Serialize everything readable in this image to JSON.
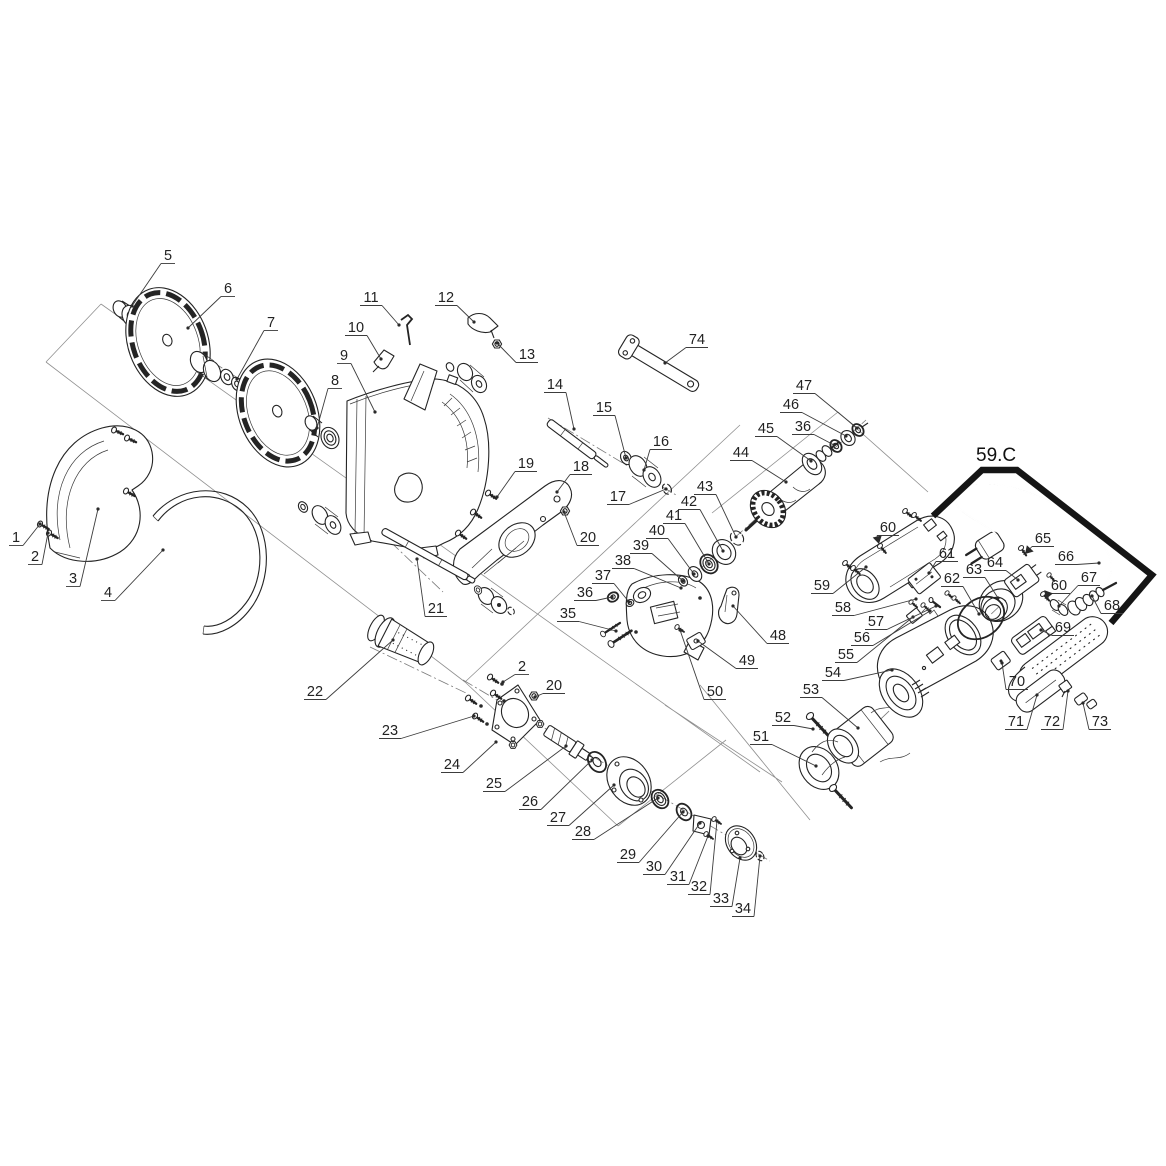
{
  "callout": {
    "label": "59.C",
    "label_x": 976,
    "label_y": 461,
    "bracket_points": "933,516 982,470 1017,470 1152,575 1111,623"
  },
  "colors": {
    "line_art": "#242424",
    "bracket": "#151515",
    "background": "#ffffff"
  },
  "labels": [
    {
      "n": "1",
      "x": 16,
      "y": 537,
      "px": 40,
      "py": 524
    },
    {
      "n": "2",
      "x": 35,
      "y": 556,
      "px": 48,
      "py": 533
    },
    {
      "n": "3",
      "x": 73,
      "y": 578,
      "px": 98,
      "py": 509
    },
    {
      "n": "4",
      "x": 108,
      "y": 592,
      "px": 163,
      "py": 550
    },
    {
      "n": "5",
      "x": 168,
      "y": 255,
      "px": 132,
      "py": 306
    },
    {
      "n": "6",
      "x": 228,
      "y": 288,
      "px": 188,
      "py": 328
    },
    {
      "n": "7",
      "x": 271,
      "y": 322,
      "px": 237,
      "py": 379
    },
    {
      "n": "8",
      "x": 335,
      "y": 380,
      "px": 317,
      "py": 428
    },
    {
      "n": "9",
      "x": 344,
      "y": 355,
      "px": 375,
      "py": 412
    },
    {
      "n": "10",
      "x": 356,
      "y": 327,
      "px": 381,
      "py": 359
    },
    {
      "n": "11",
      "x": 371,
      "y": 297,
      "px": 399,
      "py": 325
    },
    {
      "n": "12",
      "x": 446,
      "y": 297,
      "px": 474,
      "py": 322
    },
    {
      "n": "13",
      "x": 527,
      "y": 354,
      "px": 497,
      "py": 343
    },
    {
      "n": "14",
      "x": 555,
      "y": 384,
      "px": 574,
      "py": 429
    },
    {
      "n": "15",
      "x": 604,
      "y": 407,
      "px": 626,
      "py": 458
    },
    {
      "n": "16",
      "x": 661,
      "y": 441,
      "px": 644,
      "py": 470
    },
    {
      "n": "17",
      "x": 618,
      "y": 496,
      "px": 666,
      "py": 489
    },
    {
      "n": "18",
      "x": 581,
      "y": 466,
      "px": 557,
      "py": 492
    },
    {
      "n": "19",
      "x": 526,
      "y": 463,
      "px": 497,
      "py": 497
    },
    {
      "n": "20",
      "x": 588,
      "y": 537,
      "px": 564,
      "py": 512
    },
    {
      "n": "20",
      "x": 554,
      "y": 685,
      "px": 535,
      "py": 697
    },
    {
      "n": "2",
      "x": 522,
      "y": 666,
      "px": 503,
      "py": 682
    },
    {
      "n": "21",
      "x": 436,
      "y": 608,
      "px": 417,
      "py": 559
    },
    {
      "n": "22",
      "x": 315,
      "y": 691,
      "px": 393,
      "py": 640
    },
    {
      "n": "23",
      "x": 390,
      "y": 730,
      "px": 474,
      "py": 716
    },
    {
      "n": "24",
      "x": 452,
      "y": 764,
      "px": 496,
      "py": 742
    },
    {
      "n": "25",
      "x": 494,
      "y": 783,
      "px": 566,
      "py": 746
    },
    {
      "n": "26",
      "x": 530,
      "y": 801,
      "px": 592,
      "py": 760
    },
    {
      "n": "27",
      "x": 558,
      "y": 817,
      "px": 614,
      "py": 785
    },
    {
      "n": "28",
      "x": 583,
      "y": 831,
      "px": 658,
      "py": 798
    },
    {
      "n": "29",
      "x": 628,
      "y": 854,
      "px": 683,
      "py": 812
    },
    {
      "n": "30",
      "x": 654,
      "y": 866,
      "px": 700,
      "py": 823
    },
    {
      "n": "31",
      "x": 678,
      "y": 876,
      "px": 708,
      "py": 836
    },
    {
      "n": "32",
      "x": 699,
      "y": 886,
      "px": 717,
      "py": 821
    },
    {
      "n": "33",
      "x": 721,
      "y": 898,
      "px": 740,
      "py": 858
    },
    {
      "n": "34",
      "x": 743,
      "y": 908,
      "px": 760,
      "py": 856
    },
    {
      "n": "35",
      "x": 568,
      "y": 613,
      "px": 616,
      "py": 631
    },
    {
      "n": "36",
      "x": 585,
      "y": 592,
      "px": 612,
      "py": 597
    },
    {
      "n": "37",
      "x": 603,
      "y": 575,
      "px": 629,
      "py": 602
    },
    {
      "n": "38",
      "x": 623,
      "y": 560,
      "px": 681,
      "py": 588
    },
    {
      "n": "39",
      "x": 641,
      "y": 545,
      "px": 683,
      "py": 581
    },
    {
      "n": "40",
      "x": 657,
      "y": 530,
      "px": 694,
      "py": 574
    },
    {
      "n": "41",
      "x": 674,
      "y": 515,
      "px": 709,
      "py": 564
    },
    {
      "n": "42",
      "x": 689,
      "y": 501,
      "px": 723,
      "py": 551
    },
    {
      "n": "43",
      "x": 705,
      "y": 486,
      "px": 736,
      "py": 537
    },
    {
      "n": "44",
      "x": 741,
      "y": 452,
      "px": 786,
      "py": 482
    },
    {
      "n": "45",
      "x": 766,
      "y": 428,
      "px": 811,
      "py": 461
    },
    {
      "n": "46",
      "x": 791,
      "y": 404,
      "px": 846,
      "py": 436
    },
    {
      "n": "47",
      "x": 804,
      "y": 385,
      "px": 857,
      "py": 428
    },
    {
      "n": "36",
      "x": 803,
      "y": 426,
      "px": 834,
      "py": 445
    },
    {
      "n": "48",
      "x": 778,
      "y": 635,
      "px": 733,
      "py": 606
    },
    {
      "n": "49",
      "x": 747,
      "y": 660,
      "px": 698,
      "py": 641
    },
    {
      "n": "50",
      "x": 715,
      "y": 691,
      "px": 680,
      "py": 630
    },
    {
      "n": "51",
      "x": 761,
      "y": 736,
      "px": 816,
      "py": 766
    },
    {
      "n": "52",
      "x": 783,
      "y": 717,
      "px": 813,
      "py": 729
    },
    {
      "n": "53",
      "x": 811,
      "y": 689,
      "px": 858,
      "py": 728
    },
    {
      "n": "54",
      "x": 833,
      "y": 672,
      "px": 892,
      "py": 670
    },
    {
      "n": "55",
      "x": 846,
      "y": 654,
      "px": 913,
      "py": 617
    },
    {
      "n": "56",
      "x": 862,
      "y": 637,
      "px": 930,
      "py": 611
    },
    {
      "n": "57",
      "x": 876,
      "y": 621,
      "px": 936,
      "py": 606
    },
    {
      "n": "58",
      "x": 843,
      "y": 607,
      "px": 916,
      "py": 599
    },
    {
      "n": "59",
      "x": 822,
      "y": 585,
      "px": 866,
      "py": 567
    },
    {
      "n": "60",
      "x": 888,
      "y": 527,
      "px": 879,
      "py": 544,
      "a": 1
    },
    {
      "n": "60",
      "x": 1059,
      "y": 585,
      "px": 1046,
      "py": 599,
      "a": 1
    },
    {
      "n": "61",
      "x": 947,
      "y": 553,
      "px": 929,
      "py": 573
    },
    {
      "n": "62",
      "x": 952,
      "y": 578,
      "px": 979,
      "py": 614
    },
    {
      "n": "63",
      "x": 974,
      "y": 569,
      "px": 998,
      "py": 598
    },
    {
      "n": "64",
      "x": 995,
      "y": 562,
      "px": 1018,
      "py": 580
    },
    {
      "n": "65",
      "x": 1043,
      "y": 538,
      "px": 1025,
      "py": 554,
      "a": 1
    },
    {
      "n": "66",
      "x": 1066,
      "y": 556,
      "px": 1099,
      "py": 563
    },
    {
      "n": "67",
      "x": 1089,
      "y": 577,
      "px": 1059,
      "py": 606
    },
    {
      "n": "68",
      "x": 1112,
      "y": 605,
      "px": 1092,
      "py": 596
    },
    {
      "n": "69",
      "x": 1063,
      "y": 627,
      "px": 1041,
      "py": 630
    },
    {
      "n": "70",
      "x": 1017,
      "y": 681,
      "px": 1002,
      "py": 663
    },
    {
      "n": "71",
      "x": 1016,
      "y": 721,
      "px": 1037,
      "py": 695
    },
    {
      "n": "72",
      "x": 1052,
      "y": 721,
      "px": 1068,
      "py": 691
    },
    {
      "n": "73",
      "x": 1100,
      "y": 721,
      "px": 1083,
      "py": 703
    },
    {
      "n": "74",
      "x": 697,
      "y": 339,
      "px": 665,
      "py": 363
    }
  ]
}
